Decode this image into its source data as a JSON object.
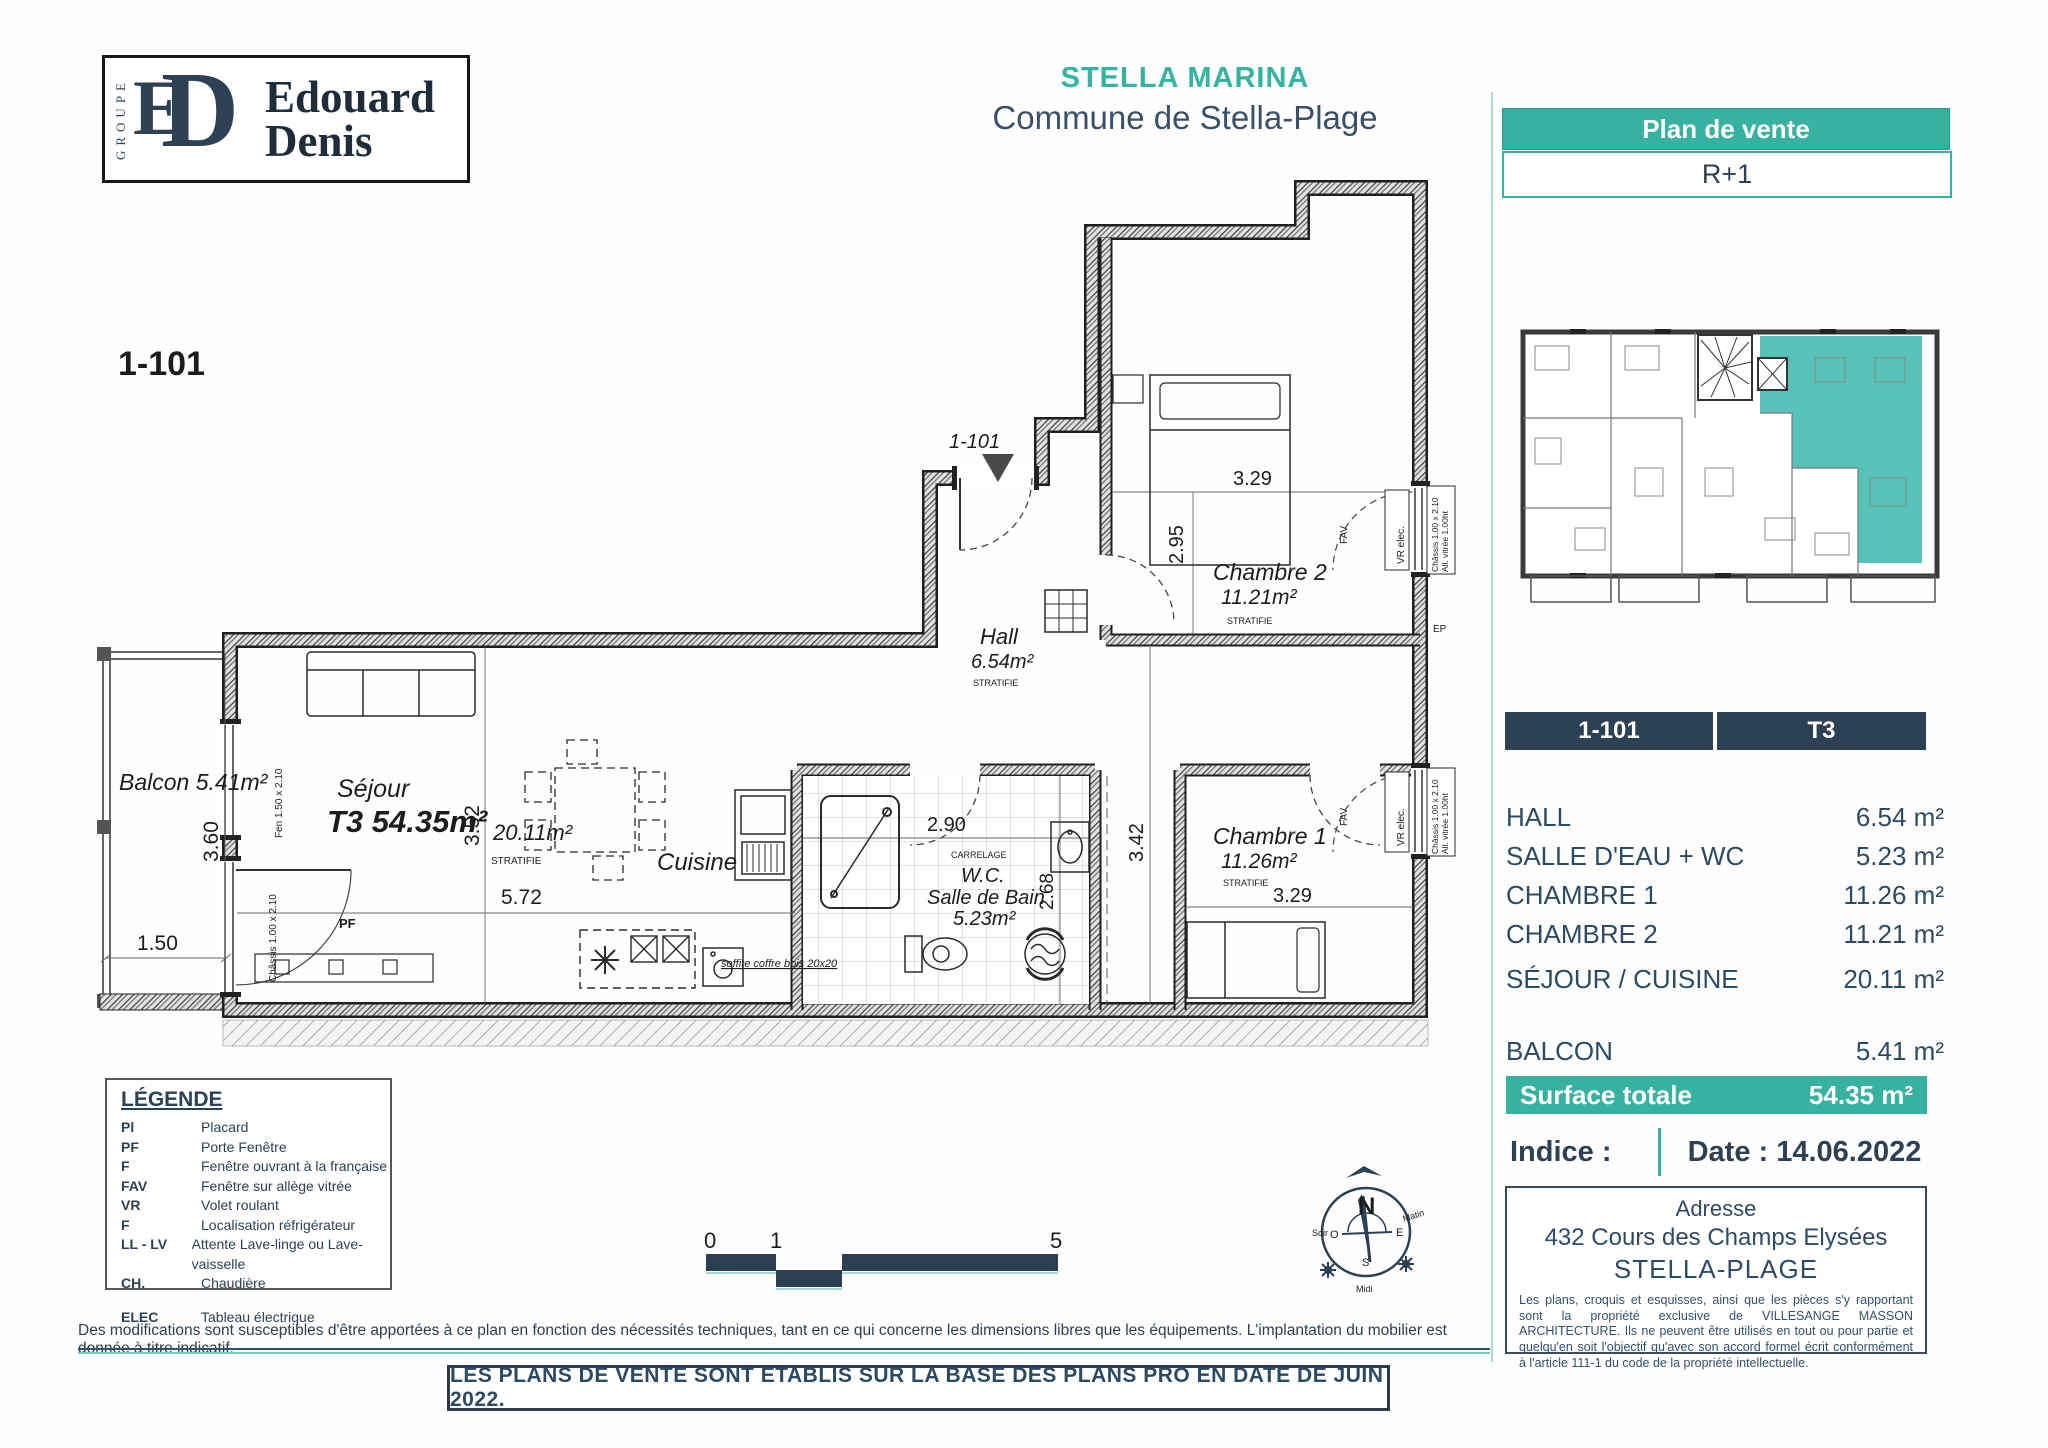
{
  "brand": {
    "groupe": "GROUPE",
    "monogram_e": "E",
    "monogram_d": "D",
    "name1": "Edouard",
    "name2": "Denis"
  },
  "header": {
    "project": "STELLA MARINA",
    "commune": "Commune de Stella-Plage"
  },
  "sidebar": {
    "plan_de_vente": "Plan de vente",
    "niveau": "R+1",
    "unit": "1-101",
    "type": "T3",
    "rooms": [
      {
        "label": "HALL",
        "area": "6.54 m²"
      },
      {
        "label": "SALLE D'EAU + WC",
        "area": "5.23 m²"
      },
      {
        "label": "CHAMBRE 1",
        "area": "11.26 m²"
      },
      {
        "label": "CHAMBRE 2",
        "area": "11.21 m²"
      },
      {
        "label": "SÉJOUR / CUISINE",
        "area": "20.11 m²"
      }
    ],
    "balcon": {
      "label": "BALCON",
      "area": "5.41 m²"
    },
    "surface": {
      "label": "Surface totale",
      "value": "54.35 m²"
    },
    "indice": "Indice :",
    "date": "Date : 14.06.2022",
    "adresse": {
      "title": "Adresse",
      "line1": "432 Cours des Champs Elysées",
      "line2": "STELLA-PLAGE"
    },
    "mention": "Les plans, croquis et esquisses, ainsi que les pièces s'y rapportant sont la propriété exclusive de VILLESANGE MASSON ARCHITECTURE. Ils ne peuvent être utilisés en tout ou pour partie et quelqu'en soit l'objectif qu'avec son accord formel écrit conformément à l'article 111-1 du code de la propriété intellectuelle."
  },
  "legend": {
    "title": "LÉGENDE",
    "items": [
      {
        "abbr": "Pl",
        "label": "Placard"
      },
      {
        "abbr": "PF",
        "label": "Porte Fenêtre"
      },
      {
        "abbr": "F",
        "label": "Fenêtre ouvrant à la française"
      },
      {
        "abbr": "FAV",
        "label": "Fenêtre sur allège vitrée"
      },
      {
        "abbr": "VR",
        "label": "Volet roulant"
      },
      {
        "abbr": "F",
        "label": "Localisation réfrigérateur"
      },
      {
        "abbr": "LL - LV",
        "label": "Attente Lave-linge ou Lave-vaisselle"
      },
      {
        "abbr": "CH.",
        "label": "Chaudière"
      },
      {
        "abbr": "ELEC",
        "label": "Tableau électrique"
      }
    ]
  },
  "plan": {
    "unit_tag": "1-101",
    "entrance": "1-101",
    "balcon": "Balcon 5.41m²",
    "sejour": "Séjour",
    "sejour_type": "T3 54.35m²",
    "sejour_area": "20.11m²",
    "cuisine": "Cuisine",
    "hall": "Hall",
    "hall_area": "6.54m²",
    "wc": "W.C.",
    "sdb": "Salle de Bain",
    "sdb_area": "5.23m²",
    "carrelage": "CARRELAGE",
    "ch1": "Chambre 1",
    "ch1_area": "11.26m²",
    "ch2": "Chambre 2",
    "ch2_area": "11.21m²",
    "stratifie": "STRATIFIE",
    "pf": "PF",
    "fav": "FAV",
    "ep": "EP",
    "vr": "VR elec.",
    "fen": "Fen 1.50 x 2.10",
    "chassis": "Châssis 1.00 x 2.10",
    "allege": "All. vitrée 1.00ht",
    "soffite": "soffite coffre bois 20x20",
    "dims": {
      "d360": "3.60",
      "d150": "1.50",
      "d352": "3.52",
      "d572": "5.72",
      "d290": "2.90",
      "d268": "2.68",
      "d342": "3.42",
      "d295": "2.95",
      "d329a": "3.29",
      "d329b": "3.29"
    }
  },
  "compass": {
    "n": "N",
    "s": "S",
    "e": "E",
    "o": "O",
    "soir": "Soir",
    "matin": "Matin",
    "midi": "Midi"
  },
  "scalebar": {
    "l0": "0",
    "l1": "1",
    "l5": "5"
  },
  "footer": {
    "disclaimer": "Des modifications sont susceptibles d'être apportées à ce plan en fonction des nécessités techniques, tant en ce qui concerne les dimensions libres que les équipements. L'implantation du mobilier est donnée à titre indicatif.",
    "notice": "LES PLANS DE VENTE SONT ETABLIS SUR LA BASE DES PLANS PRO EN DATE DE JUIN 2022."
  },
  "colors": {
    "teal": "#38b2a0",
    "navy": "#2d4154"
  }
}
